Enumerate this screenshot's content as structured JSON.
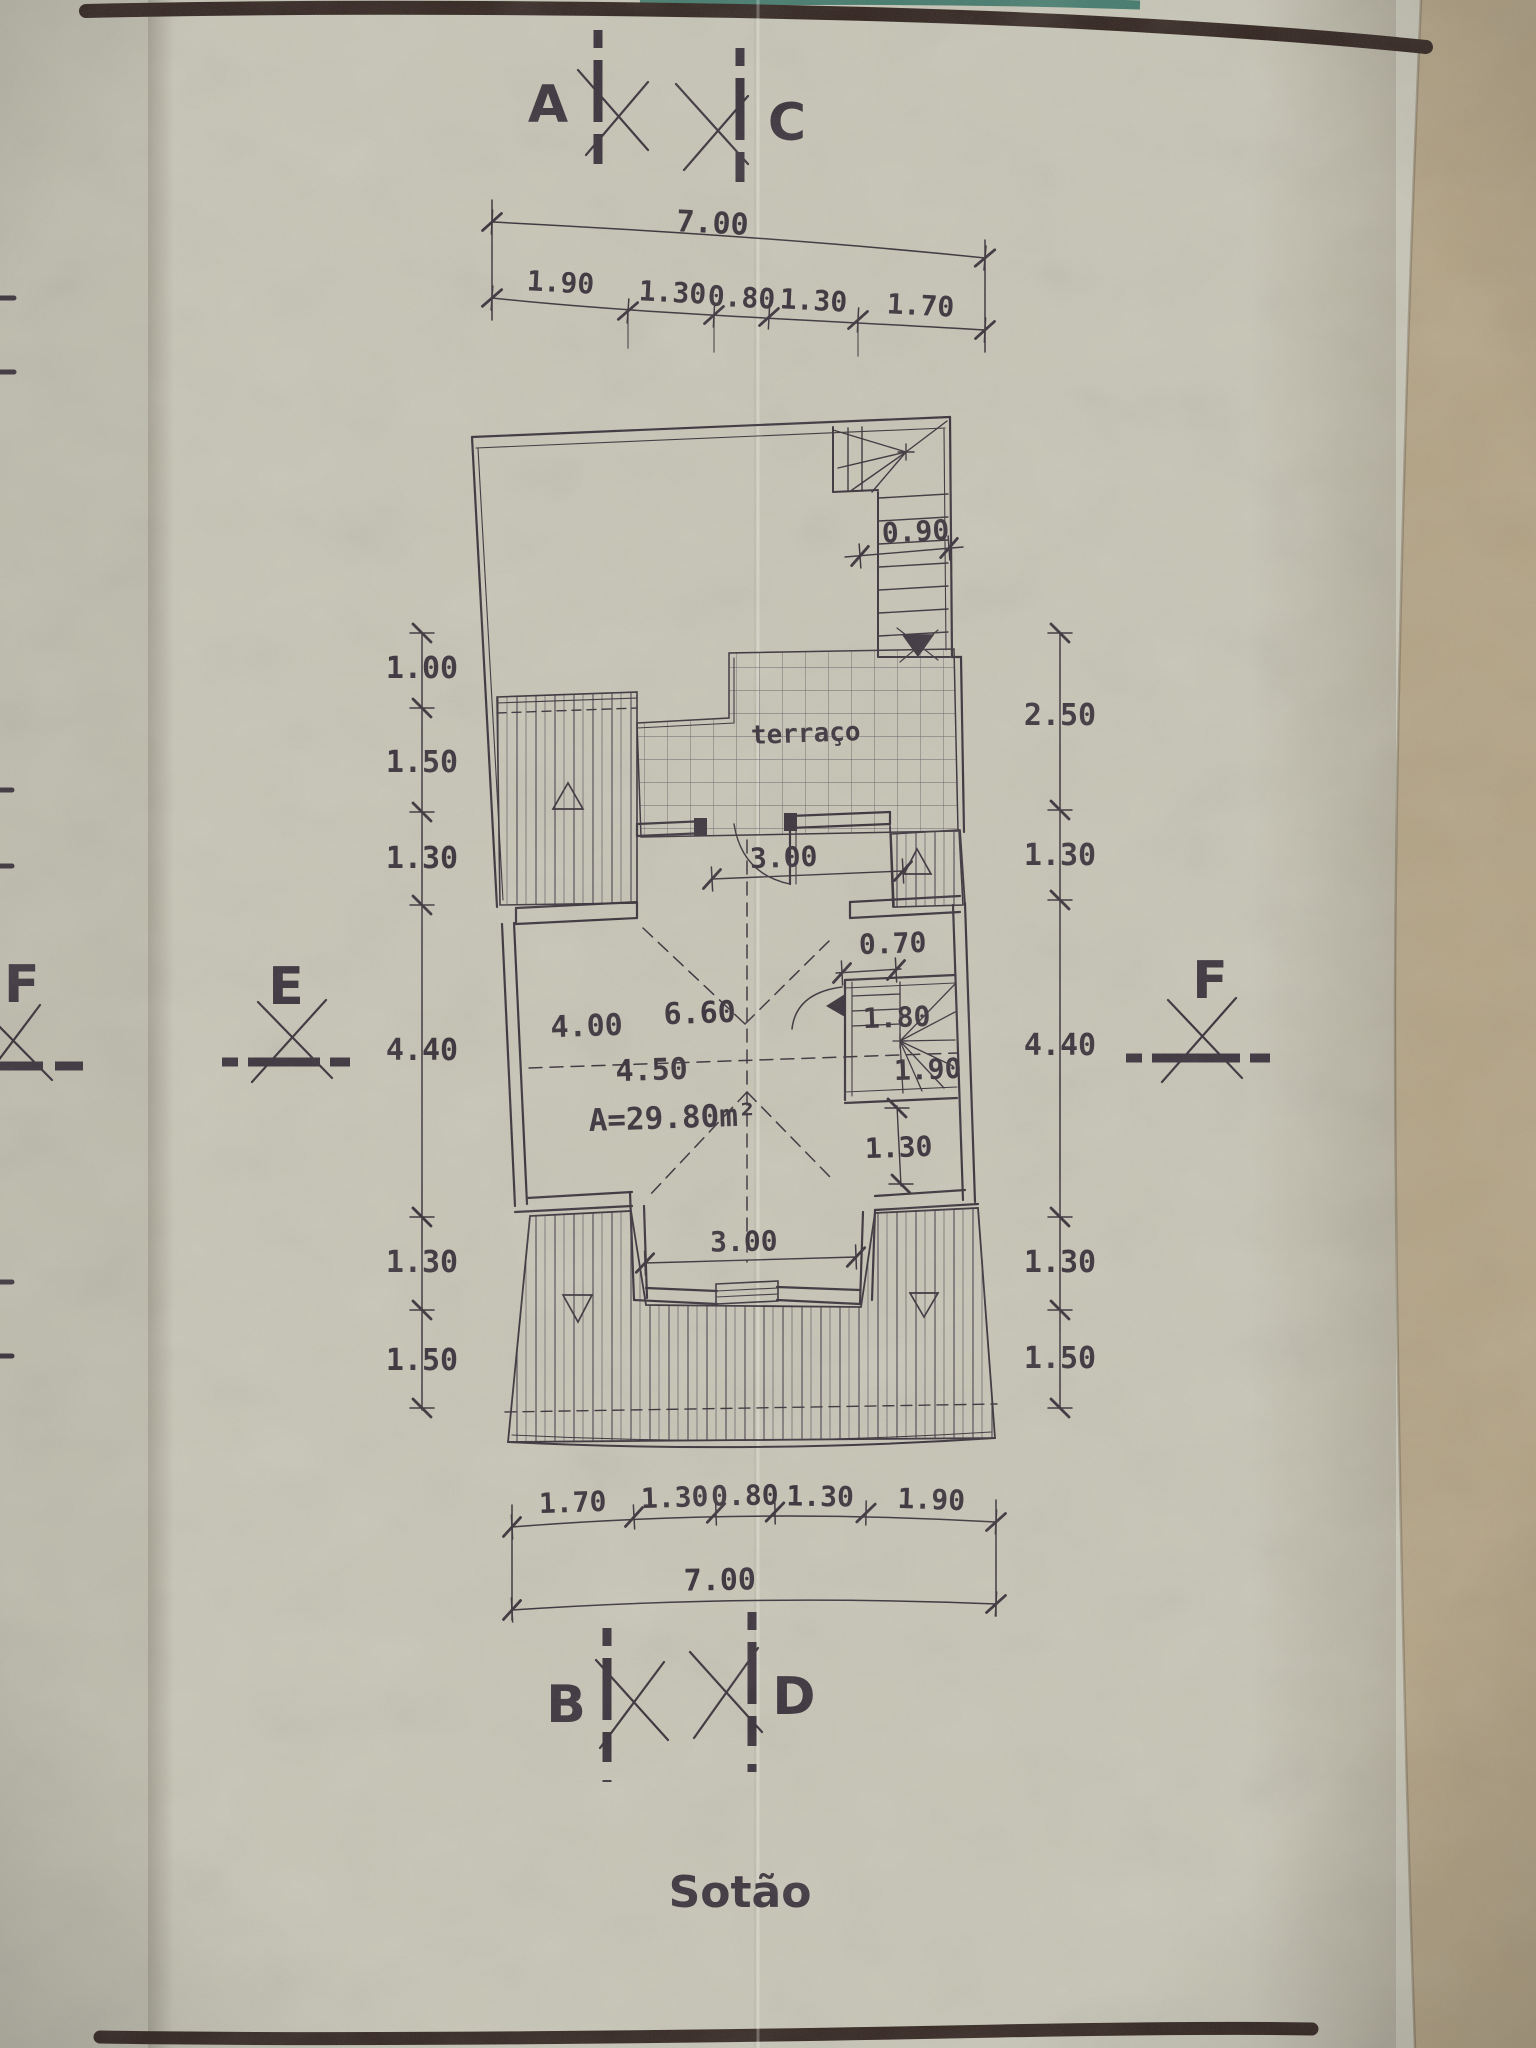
{
  "drawing": {
    "title": "Sotão",
    "terrace_label": "terraço",
    "area_label": "A=29.80m²",
    "markers": {
      "a": "A",
      "c": "C",
      "b": "B",
      "d": "D",
      "e": "E",
      "f_left": "F",
      "f_right": "F"
    },
    "dims": {
      "top_total": "7.00",
      "top": [
        "1.90",
        "1.30",
        "0.80",
        "1.30",
        "1.70"
      ],
      "left": [
        "1.00",
        "1.50",
        "1.30",
        "4.40",
        "1.30",
        "1.50"
      ],
      "right": [
        "2.50",
        "1.30",
        "4.40",
        "1.30",
        "1.50"
      ],
      "bottom": [
        "1.70",
        "1.30",
        "0.80",
        "1.30",
        "1.90"
      ],
      "bottom_total": "7.00",
      "stair_top": "0.90",
      "door_top": "3.00",
      "passage": "0.70",
      "room_width": "6.60",
      "room_left": "4.00",
      "room_mid": "4.50",
      "stair_upper": "1.80",
      "stair_lower": "1.90",
      "below_stair": "1.30",
      "door_bottom": "3.00"
    }
  },
  "colors": {
    "paper": "#c7c5b5",
    "paper_left_sheet": "#bdbbab",
    "paper_edge_tan": "#b2a283",
    "border_band": "#2e201b",
    "teal_edge": "#41796a",
    "ink": "#352d36"
  }
}
